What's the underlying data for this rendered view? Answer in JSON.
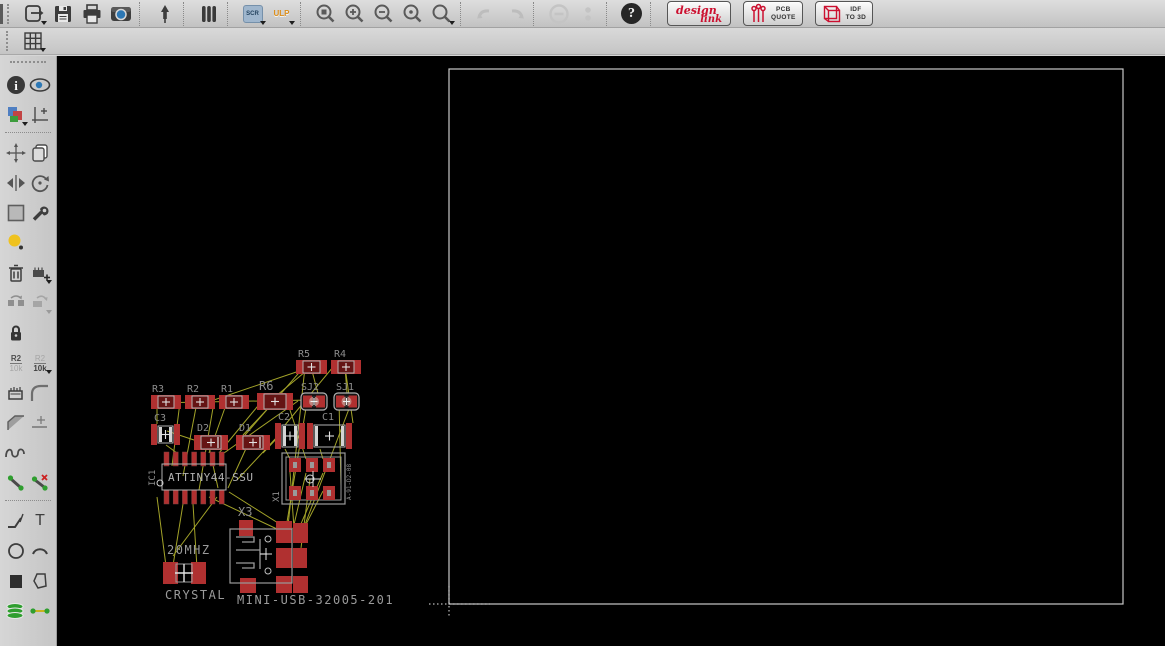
{
  "toolbar": {
    "scr": "SCR",
    "ulp": "ULP",
    "help": "?",
    "design_link": {
      "line1": "design",
      "line2": "link"
    },
    "pcb_quote": {
      "line1": "PCB",
      "line2": "QUOTE"
    },
    "idf_3d": {
      "line1": "IDF",
      "line2": "TO 3D"
    }
  },
  "command_bar": {
    "coordinates": "0.05 inch (3.25 2.30)",
    "command_value": ""
  },
  "sidebar": {
    "name_tool": {
      "top": "R2",
      "bottom": "10k"
    },
    "value_tool": {
      "top": "R2",
      "bottom": "10k"
    }
  },
  "icons": {
    "info": "i",
    "text_tool": "T"
  },
  "colors": {
    "pad_red": "#b03030",
    "body_red": "#651414",
    "outline_gray": "#b2b2b2",
    "label_gray": "#9a9a9a",
    "airwire": "#b5b52e",
    "board_edge": "#c9c9c9",
    "canvas": "#000000",
    "jumper_blob": "#c4908a"
  },
  "board": {
    "outline": {
      "x": 392,
      "y": 13,
      "w": 674,
      "h": 535
    },
    "origin": {
      "x": 392,
      "y": 548
    },
    "components": [
      {
        "type": "resistor",
        "ref": "R5",
        "x": 239,
        "y": 304,
        "w": 31,
        "h": 14,
        "lx": 241,
        "ly": 301
      },
      {
        "type": "resistor",
        "ref": "R4",
        "x": 274,
        "y": 304,
        "w": 30,
        "h": 14,
        "lx": 277,
        "ly": 301
      },
      {
        "type": "resistor",
        "ref": "R3",
        "x": 94,
        "y": 339,
        "w": 30,
        "h": 14,
        "lx": 95,
        "ly": 336
      },
      {
        "type": "resistor",
        "ref": "R2",
        "x": 128,
        "y": 339,
        "w": 30,
        "h": 14,
        "lx": 130,
        "ly": 336
      },
      {
        "type": "resistor",
        "ref": "R1",
        "x": 162,
        "y": 339,
        "w": 30,
        "h": 14,
        "lx": 164,
        "ly": 336
      },
      {
        "type": "resistor",
        "ref": "R6",
        "x": 200,
        "y": 337,
        "w": 36,
        "h": 17,
        "lx": 202,
        "ly": 334,
        "big": true
      },
      {
        "type": "jumper",
        "ref": "SJ2",
        "x": 244,
        "y": 337,
        "w": 26,
        "h": 17,
        "lx": 244,
        "ly": 334
      },
      {
        "type": "jumper",
        "ref": "SJ1",
        "x": 277,
        "y": 337,
        "w": 25,
        "h": 17,
        "lx": 279,
        "ly": 334
      },
      {
        "type": "capacitor",
        "ref": "C3",
        "x": 94,
        "y": 368,
        "w": 29,
        "h": 21,
        "lx": 97,
        "ly": 365
      },
      {
        "type": "diode",
        "ref": "D2",
        "x": 137,
        "y": 379,
        "w": 34,
        "h": 15,
        "lx": 140,
        "ly": 375
      },
      {
        "type": "diode",
        "ref": "D1",
        "x": 179,
        "y": 379,
        "w": 34,
        "h": 15,
        "lx": 182,
        "ly": 375
      },
      {
        "type": "capacitor",
        "ref": "C2",
        "x": 218,
        "y": 367,
        "w": 30,
        "h": 26,
        "lx": 221,
        "ly": 364
      },
      {
        "type": "capacitor",
        "ref": "C1",
        "x": 250,
        "y": 367,
        "w": 45,
        "h": 26,
        "lx": 265,
        "ly": 364
      },
      {
        "type": "ic14",
        "ref": "IC1",
        "x": 107,
        "y": 396,
        "w": 60,
        "label": "ATTINY44-SSU"
      },
      {
        "type": "header6",
        "ref": "X1",
        "x": 225,
        "y": 397,
        "w": 63,
        "h": 51,
        "part": "A-91-D2-08"
      },
      {
        "type": "usb",
        "ref": "X3",
        "x": 173,
        "y": 473,
        "w": 62,
        "h": 54,
        "lx": 181,
        "ly": 460,
        "part": "MINI-USB-32005-201",
        "px": 180,
        "py": 548
      },
      {
        "type": "crystal",
        "value": "20MHZ",
        "name": "CRYSTAL",
        "x": 106,
        "y": 506,
        "lx": 110,
        "ly": 498,
        "nx": 108,
        "ny": 543
      }
    ],
    "airwires": [
      [
        95,
        347,
        253,
        344
      ],
      [
        254,
        311,
        148,
        347
      ],
      [
        254,
        311,
        213,
        345
      ],
      [
        254,
        311,
        263,
        345
      ],
      [
        248,
        311,
        231,
        470
      ],
      [
        288,
        311,
        290,
        337
      ],
      [
        288,
        311,
        296,
        367
      ],
      [
        247,
        311,
        188,
        379
      ],
      [
        276,
        311,
        228,
        369
      ],
      [
        100,
        346,
        100,
        368
      ],
      [
        110,
        375,
        140,
        385
      ],
      [
        123,
        346,
        115,
        410
      ],
      [
        140,
        346,
        126,
        420
      ],
      [
        157,
        346,
        142,
        434
      ],
      [
        170,
        346,
        152,
        397
      ],
      [
        205,
        345,
        162,
        397
      ],
      [
        218,
        345,
        186,
        379
      ],
      [
        230,
        345,
        249,
        403
      ],
      [
        250,
        346,
        230,
        466
      ],
      [
        282,
        345,
        284,
        430
      ],
      [
        295,
        345,
        241,
        487
      ],
      [
        109,
        389,
        120,
        397
      ],
      [
        151,
        386,
        161,
        432
      ],
      [
        192,
        386,
        171,
        432
      ],
      [
        222,
        380,
        206,
        397
      ],
      [
        180,
        424,
        220,
        381
      ],
      [
        228,
        393,
        233,
        403
      ],
      [
        263,
        393,
        266,
        403
      ],
      [
        233,
        416,
        237,
        472
      ],
      [
        249,
        417,
        236,
        473
      ],
      [
        266,
        417,
        240,
        477
      ],
      [
        266,
        435,
        242,
        482
      ],
      [
        253,
        423,
        244,
        492
      ],
      [
        229,
        472,
        172,
        436
      ],
      [
        220,
        473,
        152,
        441
      ],
      [
        113,
        528,
        126,
        448
      ],
      [
        141,
        528,
        136,
        448
      ],
      [
        109,
        510,
        100,
        441
      ],
      [
        160,
        441,
        116,
        500
      ],
      [
        167,
        397,
        241,
        345
      ]
    ]
  }
}
